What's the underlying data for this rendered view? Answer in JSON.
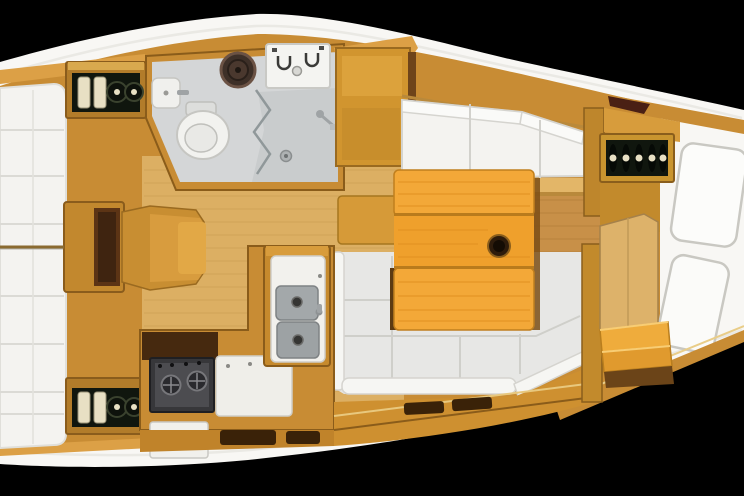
{
  "title": "Sailing yacht interior layout plan, top-down render on black background",
  "palette": {
    "bg": "#000000",
    "hull": "#f8f7f4",
    "wood_mid": "#c88c34",
    "wood_light": "#dca046",
    "wood_pale": "#dcaf63",
    "wood_bright": "#f3a838",
    "wood_dark": "#8a5a1e",
    "brown_dark": "#46290f",
    "cushion_white": "#f4f3f0",
    "seat_gray": "#e7e7e5",
    "head_floor_gray": "#d4d6d7",
    "sink_gray": "#a3a8aa",
    "stove_dark": "#37373a",
    "bottle_dark": "#10160e",
    "bottle_cream": "#e8e0c4",
    "knob_dark": "#2e1c0c",
    "outline_gray": "#c9c8c2"
  },
  "areas": {
    "bow_cabin": {
      "name": "forward cabin",
      "furniture": [
        "v-berth mattress with pillows",
        "storage locker with bottles (top)",
        "storage locker with bottles (bottom)",
        "stepped seat unit"
      ]
    },
    "head_compartment": {
      "name": "head / wet room",
      "furniture": [
        "marine toilet",
        "washbasin",
        "round dark basin",
        "two-burner stove top unit",
        "shower tray with drain",
        "shower mixer",
        "bifold door"
      ]
    },
    "saloon": {
      "name": "saloon",
      "furniture": [
        "starboard settee",
        "U-shaped port settee",
        "folding table with cup-holder knob",
        "wood floorboards",
        "tall locker cabinet"
      ]
    },
    "galley": {
      "name": "galley",
      "furniture": [
        "double sink unit",
        "two-burner cooktop",
        "refrigerator door",
        "white worktop"
      ]
    },
    "aft_area": {
      "name": "aft / companionway",
      "furniture": [
        "wine bottle rack",
        "aft berth cushions",
        "companionway steps",
        "bulkhead divider"
      ]
    }
  }
}
